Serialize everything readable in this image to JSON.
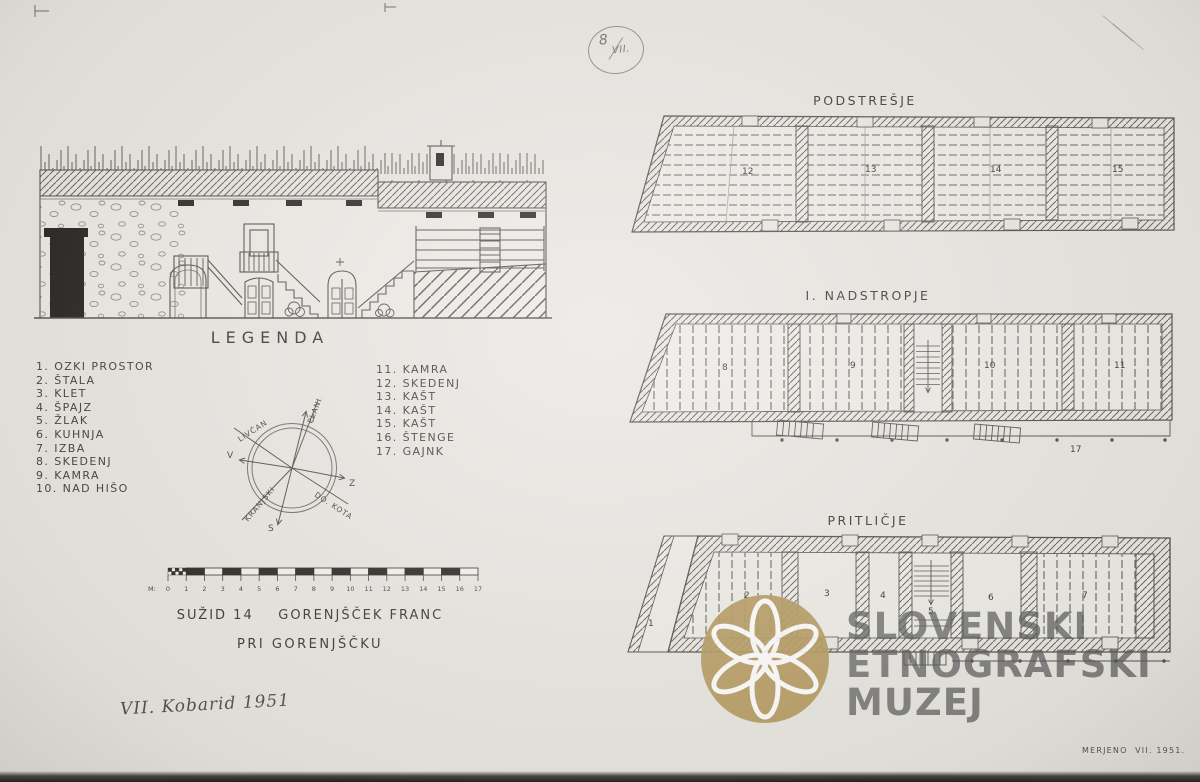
{
  "paper": {
    "background": "#e8e6e1",
    "ink": "#4a4843"
  },
  "stamp": {
    "top": "8",
    "bottom": "VII."
  },
  "legend": {
    "title": "LEGENDA",
    "items_left": [
      "1. OZKI PROSTOR",
      "2. ŠTALA",
      "3. KLET",
      "4. ŠPAJZ",
      "5. ŽLAK",
      "6. KUHNJA",
      "7. IZBA",
      "8. SKEDENJ",
      "9. KAMRA",
      "10. NAD HIŠO"
    ],
    "items_right": [
      "11. KAMRA",
      "12. SKEDENJ",
      "13. KAŠT",
      "14. KAŠT",
      "15. KAŠT",
      "16. ŠTENGE",
      "17. GAJNK"
    ]
  },
  "compass": {
    "cardinal_top": "J",
    "cardinal_left": "V",
    "cardinal_right": "Z",
    "cardinal_bottom": "S",
    "bearing_up": "PLANIK",
    "bearing_upper_left": "LIVČAN",
    "bearing_lower_left": "KRANJSKI",
    "bearing_lower_right": "DO. KOTA"
  },
  "scalebar": {
    "unit_label": "M:",
    "ticks": [
      "0",
      "1",
      "2",
      "3",
      "4",
      "5",
      "6",
      "7",
      "8",
      "9",
      "10",
      "11",
      "12",
      "13",
      "14",
      "15",
      "16",
      "17"
    ]
  },
  "title_block": {
    "line1": "SUŽID 14    GORENJŠČEK FRANC",
    "line2": "PRI GORENJŠČKU"
  },
  "note": "VII. Kobarid 1951",
  "plans": [
    {
      "label": "PODSTREŠJE",
      "rooms": [
        "12",
        "13",
        "14",
        "15"
      ]
    },
    {
      "label": "I. NADSTROPJE",
      "rooms": [
        "8",
        "9",
        "10",
        "11",
        "17"
      ]
    },
    {
      "label": "PRITLIČJE",
      "rooms": [
        "1",
        "2",
        "3",
        "4",
        "5",
        "6",
        "7"
      ]
    }
  ],
  "watermark": {
    "line1": "SLOVENSKI",
    "line2": "ETNOGRAFSKI",
    "line3": "MUZEJ",
    "logo_color": "#b39659",
    "text_color": "#515254"
  },
  "footer_note": "MERJENO  VII. 1951."
}
